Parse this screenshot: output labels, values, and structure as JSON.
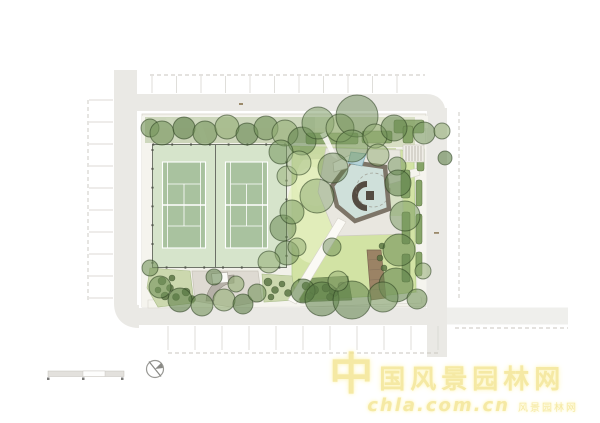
{
  "watermark": {
    "brand_logo_char": "中",
    "brand_text": "国风景园林网",
    "url_text": "chla.com.cn",
    "tagline_text": "风景园林网"
  },
  "colors": {
    "street": "#eae9e5",
    "parkBase": "#f2f1ea",
    "path": "#f5f4ee",
    "apron": "#d6e4cb",
    "court": "#a9c29f",
    "courtLine": "#ffffff",
    "fence": "#70756a",
    "lawn": "#d2e3a4",
    "lawnLight": "#e6f0c2",
    "hedge": "#86a468",
    "bed": "#ccd8ae",
    "shrub": "#55713f",
    "shrubMass": "#6f8c54",
    "plaza": "#dedad2",
    "plazaRing": "#b5b0a7",
    "roof": "#7d7568",
    "roofDark": "#544c42",
    "terrace": "#cfe0da",
    "pool": "#b5d3d8",
    "boardwalk": "#9b8365",
    "stallLine": "#d9d7d2",
    "dashLine": "#c9c6bf",
    "watermark": "#f3e48e",
    "watermarkGlow": "#fdf4b4"
  },
  "plan": {
    "tree_shades": [
      "#93ad74",
      "#74955c",
      "#5f814a",
      "#a7bf8d"
    ],
    "trees": [
      [
        150,
        128,
        9,
        1,
        0.6
      ],
      [
        162,
        133,
        12,
        1,
        0.6
      ],
      [
        184,
        128,
        11,
        2,
        0.6
      ],
      [
        205,
        133,
        12,
        1,
        0.6
      ],
      [
        227,
        127,
        12,
        0,
        0.6
      ],
      [
        247,
        134,
        11,
        2,
        0.55
      ],
      [
        266,
        128,
        12,
        1,
        0.6
      ],
      [
        285,
        133,
        13,
        0,
        0.6
      ],
      [
        302,
        141,
        14,
        2,
        0.55
      ],
      [
        318,
        123,
        16,
        1,
        0.5
      ],
      [
        340,
        128,
        14,
        0,
        0.55
      ],
      [
        357,
        116,
        21,
        2,
        0.45
      ],
      [
        352,
        146,
        16,
        1,
        0.5
      ],
      [
        375,
        136,
        12,
        0,
        0.55
      ],
      [
        394,
        128,
        13,
        2,
        0.5
      ],
      [
        424,
        133,
        11,
        1,
        0.55
      ],
      [
        442,
        131,
        8,
        0,
        0.6
      ],
      [
        445,
        158,
        7,
        2,
        0.6
      ],
      [
        281,
        152,
        12,
        1,
        0.55
      ],
      [
        287,
        176,
        10,
        0,
        0.5
      ],
      [
        283,
        228,
        13,
        2,
        0.5
      ],
      [
        287,
        253,
        12,
        1,
        0.55
      ],
      [
        269,
        262,
        11,
        0,
        0.55
      ],
      [
        299,
        163,
        12,
        3,
        0.5
      ],
      [
        292,
        212,
        12,
        1,
        0.5
      ],
      [
        297,
        247,
        9,
        0,
        0.55
      ],
      [
        332,
        247,
        9,
        2,
        0.45
      ],
      [
        333,
        168,
        15,
        2,
        0.45
      ],
      [
        317,
        196,
        17,
        1,
        0.4
      ],
      [
        378,
        155,
        11,
        0,
        0.5
      ],
      [
        397,
        166,
        9,
        1,
        0.5
      ],
      [
        398,
        183,
        13,
        2,
        0.55
      ],
      [
        405,
        216,
        15,
        1,
        0.5
      ],
      [
        399,
        250,
        16,
        2,
        0.5
      ],
      [
        396,
        285,
        17,
        2,
        0.55
      ],
      [
        417,
        299,
        10,
        1,
        0.6
      ],
      [
        423,
        271,
        8,
        0,
        0.55
      ],
      [
        303,
        291,
        12,
        2,
        0.6
      ],
      [
        322,
        299,
        17,
        2,
        0.55
      ],
      [
        352,
        300,
        19,
        2,
        0.55
      ],
      [
        383,
        297,
        15,
        1,
        0.55
      ],
      [
        338,
        281,
        10,
        0,
        0.5
      ],
      [
        160,
        287,
        11,
        1,
        0.6
      ],
      [
        180,
        300,
        12,
        2,
        0.6
      ],
      [
        202,
        305,
        11,
        1,
        0.6
      ],
      [
        224,
        300,
        11,
        0,
        0.6
      ],
      [
        243,
        304,
        10,
        2,
        0.6
      ],
      [
        257,
        293,
        9,
        1,
        0.6
      ],
      [
        236,
        284,
        8,
        0,
        0.6
      ],
      [
        214,
        277,
        8,
        2,
        0.55
      ],
      [
        150,
        268,
        8,
        1,
        0.6
      ]
    ],
    "shrubs": [
      [
        162,
        281,
        4
      ],
      [
        170,
        288,
        3.5
      ],
      [
        165,
        296,
        4
      ],
      [
        176,
        297,
        3.5
      ],
      [
        186,
        292,
        4
      ],
      [
        172,
        278,
        3
      ],
      [
        192,
        299,
        3.5
      ],
      [
        158,
        290,
        3
      ],
      [
        268,
        282,
        4
      ],
      [
        275,
        290,
        3.5
      ],
      [
        282,
        284,
        3
      ],
      [
        288,
        293,
        3.5
      ],
      [
        271,
        297,
        3
      ],
      [
        306,
        286,
        4
      ],
      [
        314,
        290,
        4.5
      ],
      [
        326,
        288,
        4
      ],
      [
        334,
        292,
        4.5
      ],
      [
        342,
        286,
        4
      ],
      [
        310,
        296,
        3.5
      ],
      [
        330,
        297,
        3.5
      ],
      [
        382,
        246,
        3
      ],
      [
        380,
        258,
        3
      ],
      [
        384,
        268,
        3
      ]
    ],
    "parking_rows": [
      {
        "dir": "v",
        "x0": 152,
        "x1": 420,
        "step": 24.5,
        "y0": 76,
        "y1": 93
      },
      {
        "dir": "h",
        "y0": 100,
        "y1": 299,
        "step": 22,
        "x0": 89,
        "x1": 113
      },
      {
        "dir": "v",
        "x0": 168,
        "x1": 438,
        "step": 27,
        "y0": 326,
        "y1": 350
      }
    ]
  }
}
